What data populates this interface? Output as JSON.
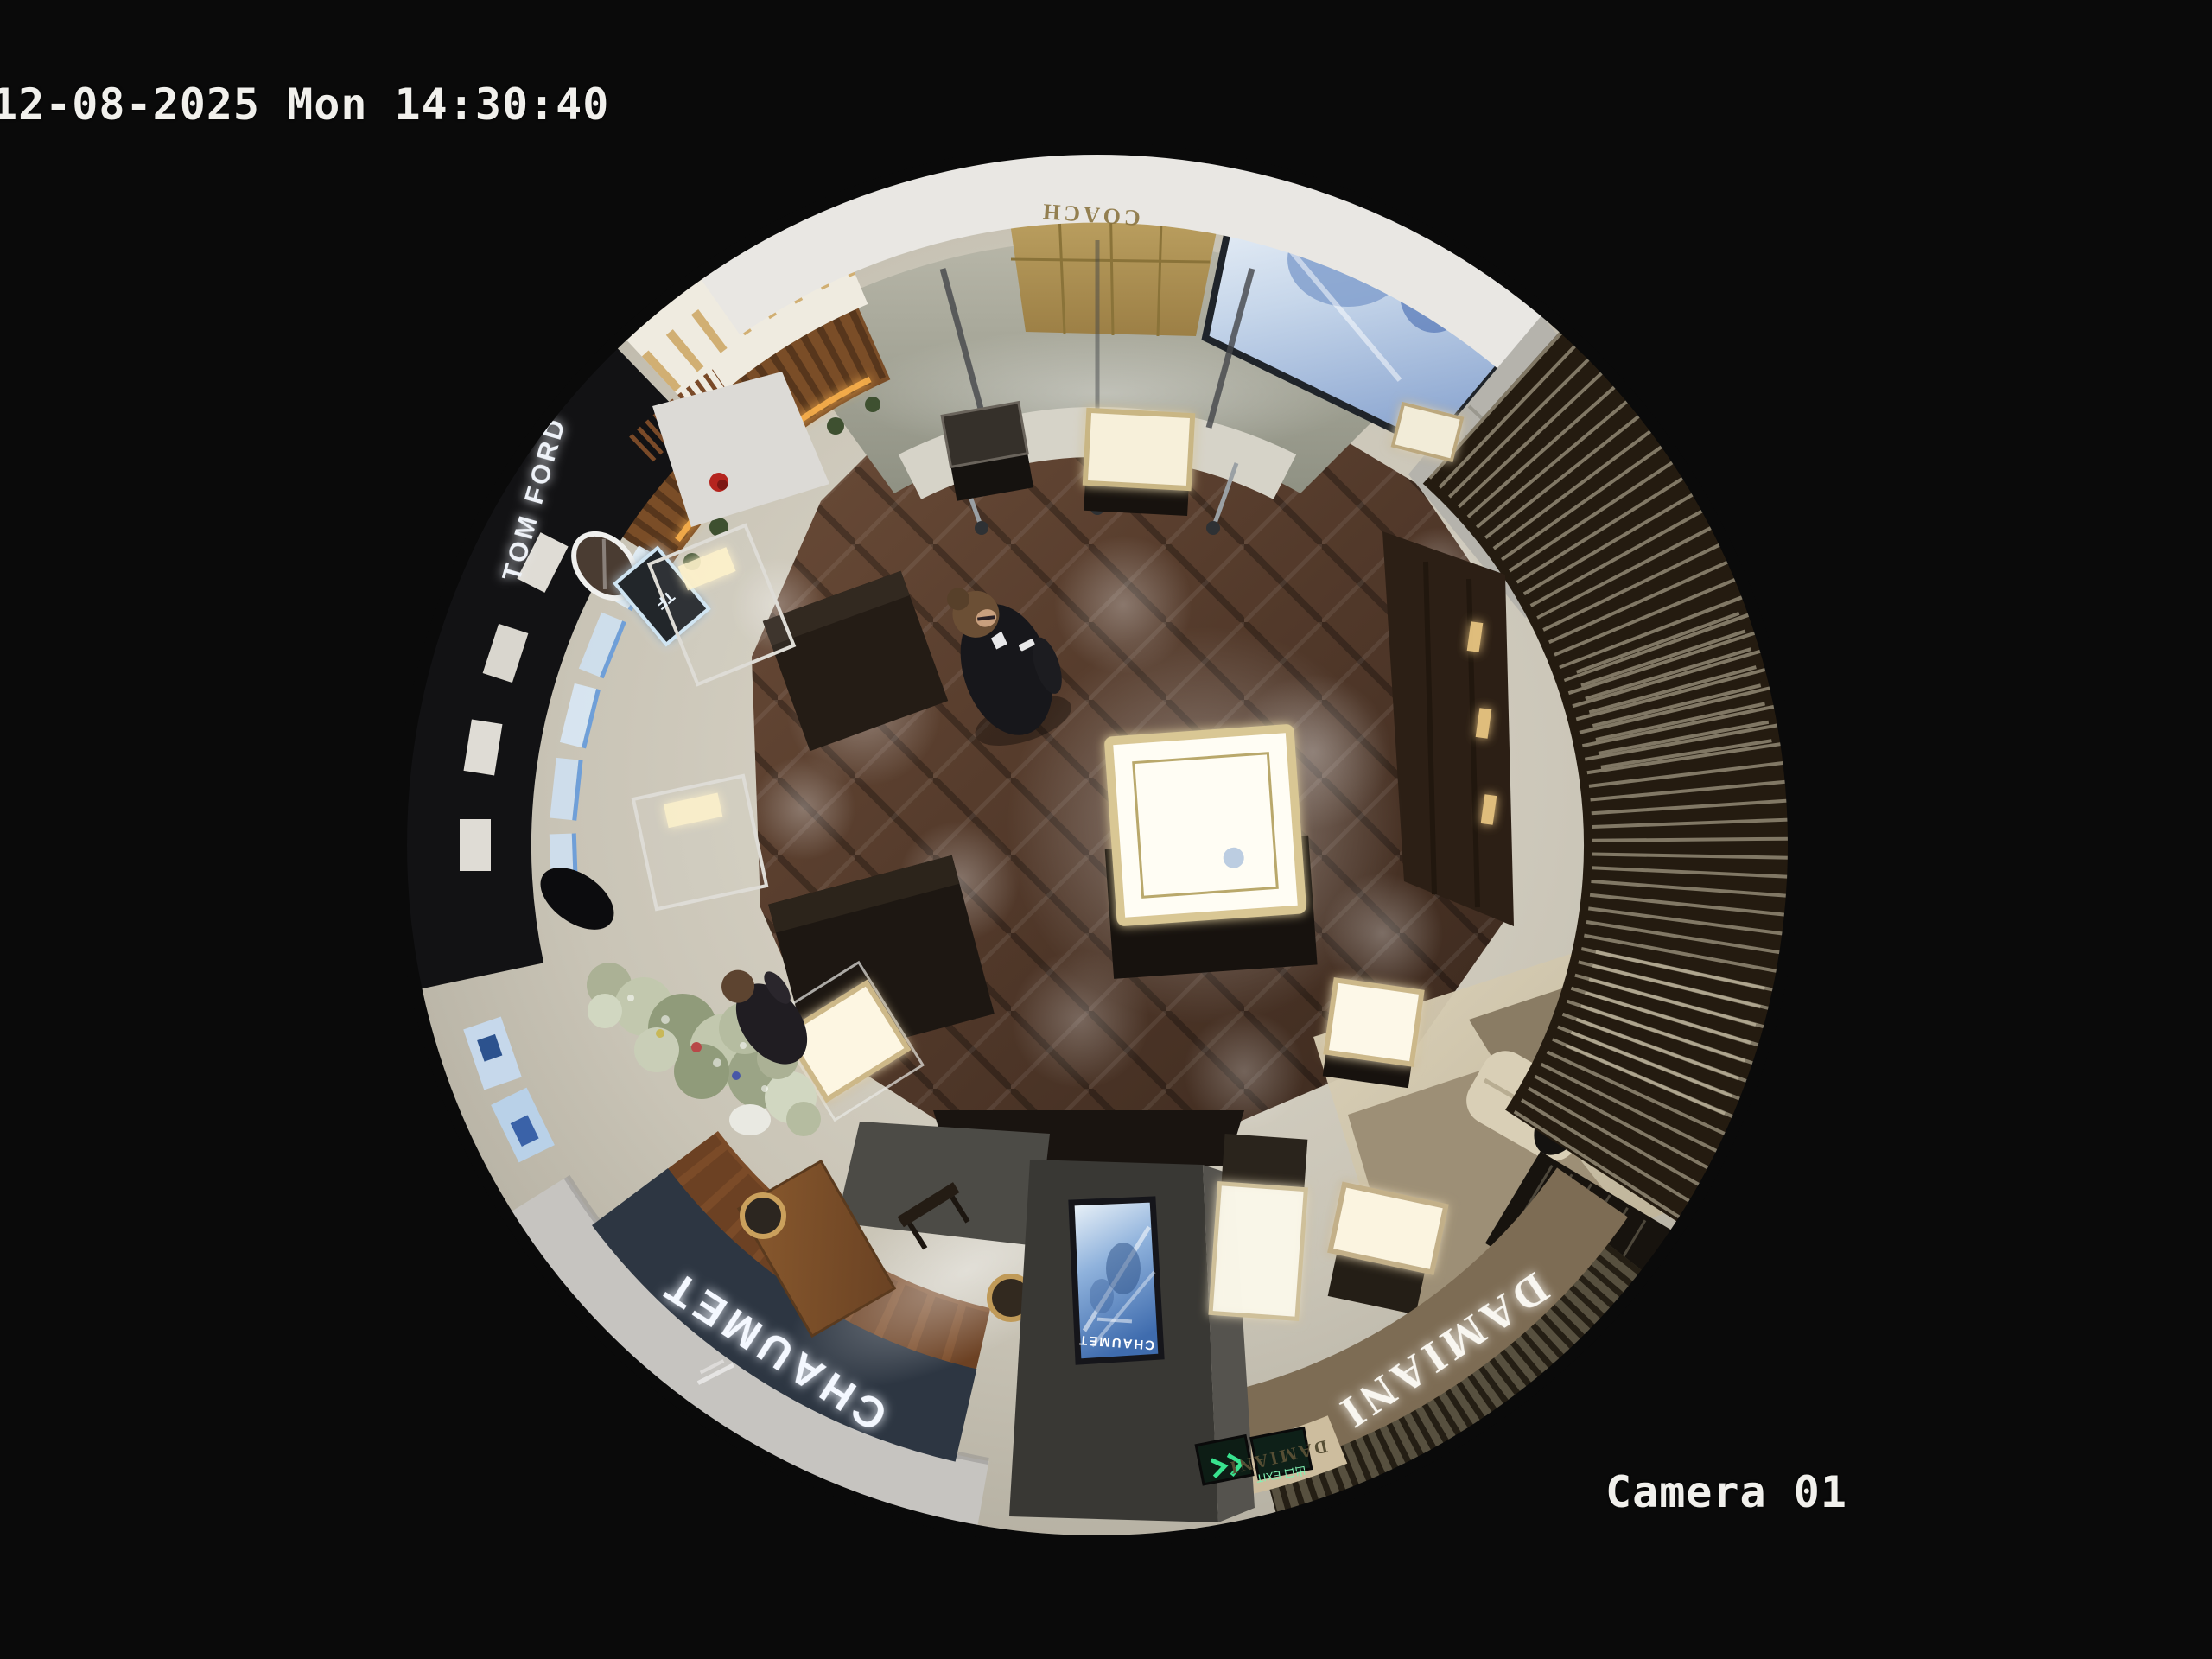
{
  "osd": {
    "timestamp": "12-08-2025 Mon 14:30:40",
    "camera_label": "Camera 01"
  },
  "scene": {
    "signage": {
      "chaumet_fascia": "CHAUMET",
      "chaumet_totem": "CHAUMET",
      "damiani_fascia": "DAMIANI",
      "damiani_entrance": "DAMIANI",
      "tom_ford": "TOM FORD",
      "tf_monogram": "TF",
      "coach_wall": "COACH",
      "exit_sign": "出口 EXIT"
    },
    "palette": {
      "background": "#0a0a0a",
      "osd_text": "#f1f0ec",
      "wood_floor": "#52392a",
      "stone_floor": "#c9c4b6",
      "corridor_floor": "#a3a295",
      "chaumet_fascia": "#2d3642",
      "damiani_fascia": "#7d6c54",
      "slat_wall": "#241b10",
      "gold_wall": "#b2965a",
      "screen_blue": "#8fb2dc",
      "exit_green": "#38e28e"
    }
  }
}
